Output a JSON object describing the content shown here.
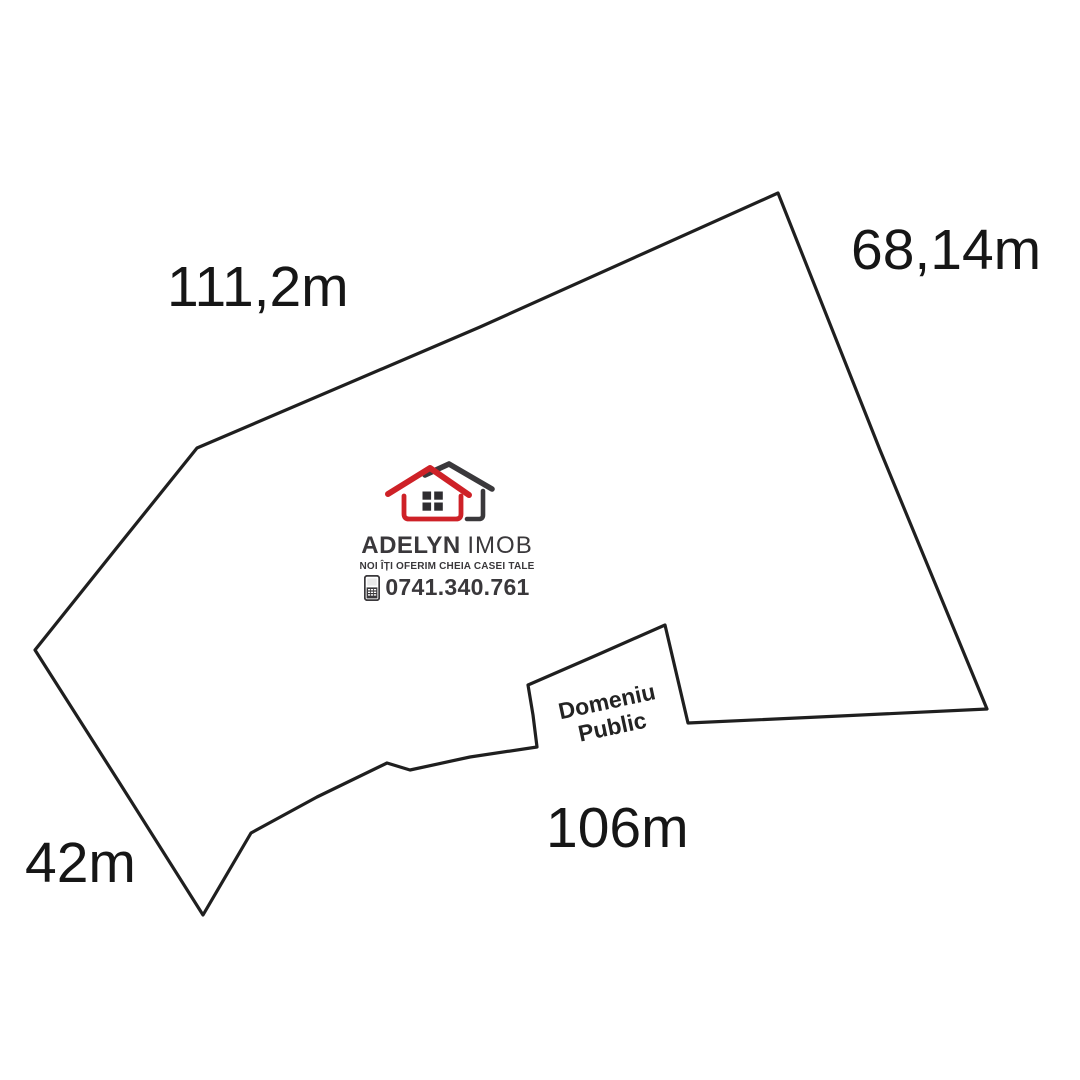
{
  "plot": {
    "outline_color": "#1f1f1f",
    "outline_points": [
      [
        778,
        193
      ],
      [
        880,
        450
      ],
      [
        987,
        709
      ],
      [
        840,
        716
      ],
      [
        688,
        723
      ],
      [
        665,
        625
      ],
      [
        597,
        655
      ],
      [
        528,
        685
      ],
      [
        533,
        715
      ],
      [
        537,
        747
      ],
      [
        470,
        757
      ],
      [
        410,
        770
      ],
      [
        387,
        763
      ],
      [
        317,
        797
      ],
      [
        251,
        833
      ],
      [
        203,
        915
      ],
      [
        119,
        782
      ],
      [
        35,
        650
      ],
      [
        115,
        550
      ],
      [
        197,
        448
      ],
      [
        480,
        327
      ]
    ],
    "measurements": {
      "top": "111,2m",
      "right": "68,14m",
      "left": "42m",
      "bottom": "106m"
    },
    "area_label": {
      "line1": "Domeniu",
      "line2": "Public"
    }
  },
  "logo": {
    "name_primary": "ADELYN",
    "name_secondary": "IMOB",
    "tagline": "NOI ÎȚI OFERIM CHEIA CASEI TALE",
    "phone": "0741.340.761",
    "icons": {
      "house": "house-logo-icon",
      "phone": "mobile-phone-icon"
    },
    "colors": {
      "red": "#ce2127",
      "dark": "#3a383b"
    }
  }
}
